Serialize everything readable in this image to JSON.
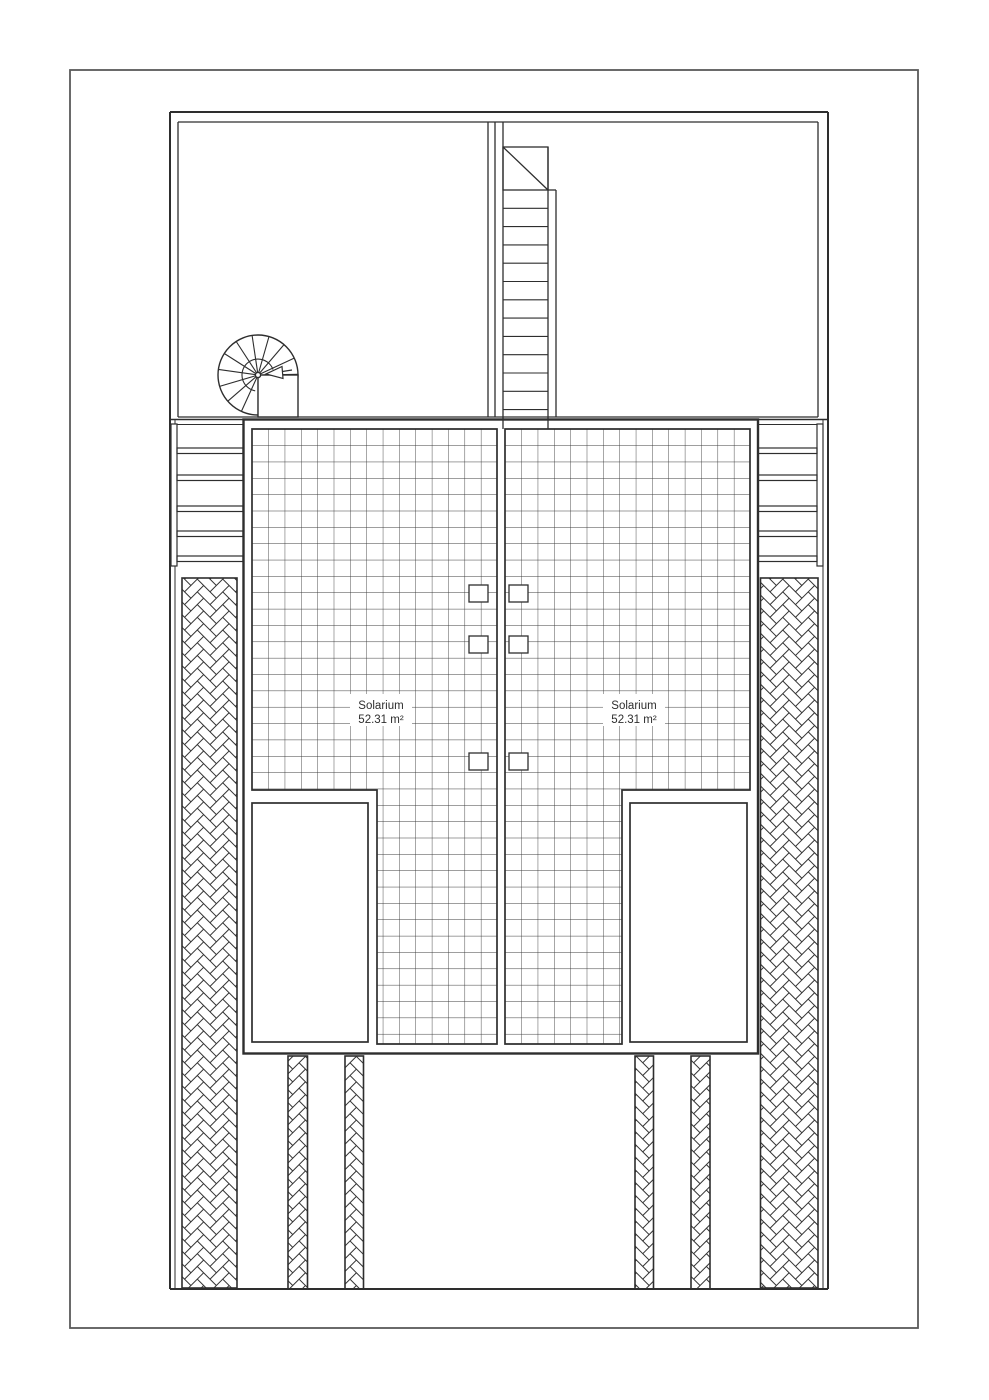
{
  "plan": {
    "solariums": [
      {
        "name": "Solarium",
        "area": "52.31 m²"
      },
      {
        "name": "Solarium",
        "area": "52.31 m²"
      }
    ],
    "colors": {
      "line": "#2e2e2e",
      "grid_line": "#3b3b3b",
      "page_background": "#ffffff",
      "page_border": "#5a5a5a"
    }
  }
}
